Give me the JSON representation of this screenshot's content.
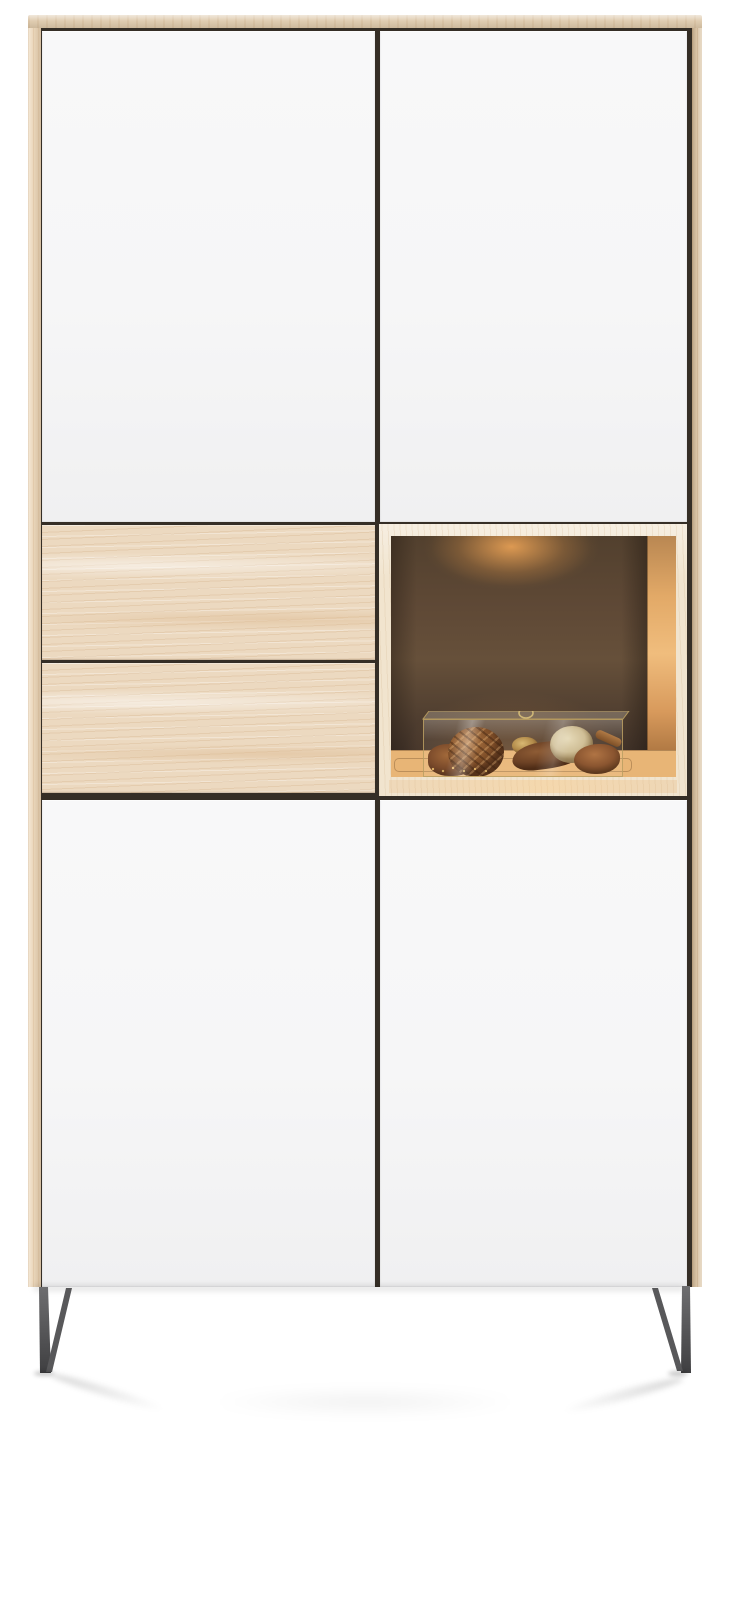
{
  "meta": {
    "type": "product-photo",
    "subject": "Tall two-column storage cabinet with white lacquered doors, natural oak drawer fronts, an illuminated open display niche and anthracite metal sled feet on a white studio background"
  },
  "cabinet": {
    "title": "Display cabinet",
    "body_material": "natural oak",
    "sections": {
      "top": {
        "left_door": "white lacquer door",
        "right_door": "white lacquer door"
      },
      "middle": {
        "drawer_1": "oak drawer front",
        "drawer_2": "oak drawer front",
        "niche": {
          "label": "open display niche",
          "light": "warm LED spotlight",
          "back_wall": "dark bronze lacquer",
          "decor_container": "glass display box with brass frame and ring handle",
          "decor_items": [
            "dried seed pods",
            "rattan ball",
            "walnut",
            "cacao pod",
            "speckled stone",
            "bark shells",
            "cinnamon stick",
            "golden potpourri bits"
          ]
        }
      },
      "bottom": {
        "left_door": "white lacquer door",
        "right_door": "white lacquer door"
      }
    },
    "legs": {
      "style": "metal sled feet",
      "finish": "anthracite"
    }
  },
  "colors": {
    "page-bg": "#ffffff",
    "wood-top": "#e0cdb1",
    "wood-side": "#ebd7bb",
    "wood-side-dark": "#d9c3a4",
    "wood-drawer": "#ecd9c0",
    "wood-frame": "#f1e4ce",
    "seam": "#352e26",
    "door-white": "#f6f6f7",
    "niche-glow": "#e09c52",
    "niche-wall": "#5f4936",
    "niche-wall-dark": "#43342a",
    "niche-floor": "#e8b576",
    "inner-wall": "#e2a967",
    "brass": "#b59a60",
    "leg-gray": "#5c5c5e",
    "leg-dark": "#414143"
  }
}
